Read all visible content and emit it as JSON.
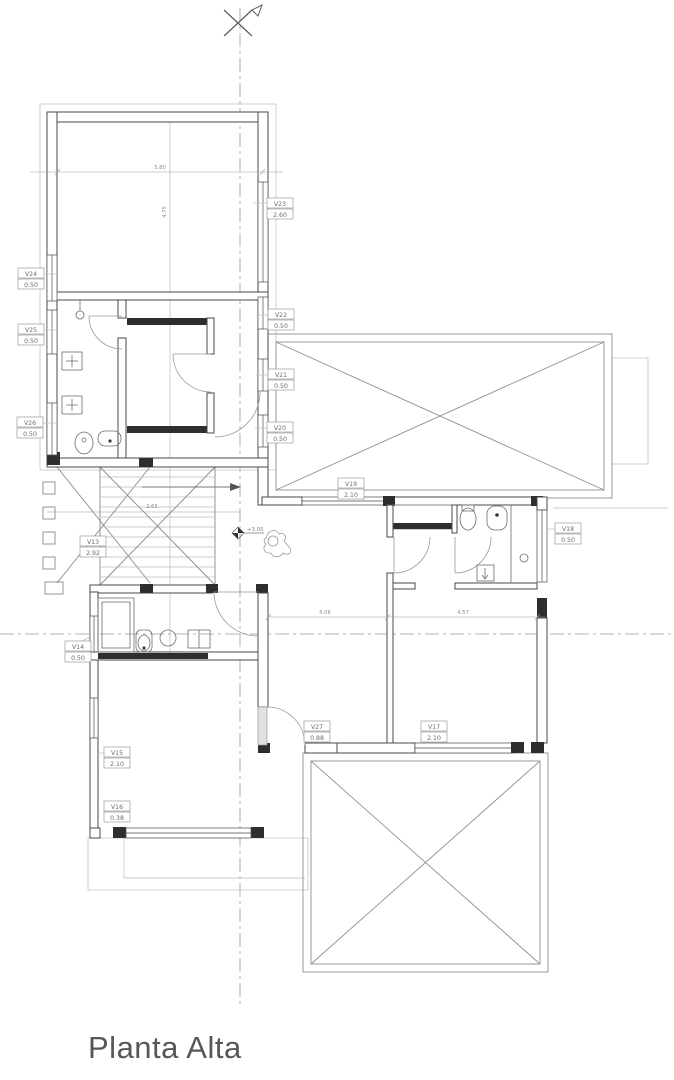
{
  "title": "Planta Alta",
  "drawing": {
    "level_marker": "+3.05",
    "window_tags": {
      "v13": {
        "name": "V13",
        "value": "2.92"
      },
      "v14": {
        "name": "V14",
        "value": "0.50"
      },
      "v15": {
        "name": "V15",
        "value": "2.10"
      },
      "v16": {
        "name": "V16",
        "value": "0.38"
      },
      "v17": {
        "name": "V17",
        "value": "2.10"
      },
      "v18": {
        "name": "V18",
        "value": "0.50"
      },
      "v19": {
        "name": "V19",
        "value": "2.10"
      },
      "v20": {
        "name": "V20",
        "value": "0.50"
      },
      "v21": {
        "name": "V21",
        "value": "0.50"
      },
      "v22": {
        "name": "V22",
        "value": "0.50"
      },
      "v23": {
        "name": "V23",
        "value": "2.60"
      },
      "v24": {
        "name": "V24",
        "value": "0.50"
      },
      "v25": {
        "name": "V25",
        "value": "0.50"
      },
      "v26": {
        "name": "V26",
        "value": "0.50"
      },
      "v27": {
        "name": "V27",
        "value": "0.88"
      }
    },
    "dimensions": {
      "bedroom_width": "5.80",
      "bedroom_height": "4.75",
      "stair_width": "2.65",
      "hall_left": "5.06",
      "hall_right": "4.57"
    },
    "icons": {
      "north_arrow": "✕",
      "level_marker": "◆"
    },
    "colors": {
      "wall_line": "#4a4a4a",
      "light_line": "#bdbdbd",
      "text": "#6b6b6b",
      "title_text": "#575757"
    }
  }
}
